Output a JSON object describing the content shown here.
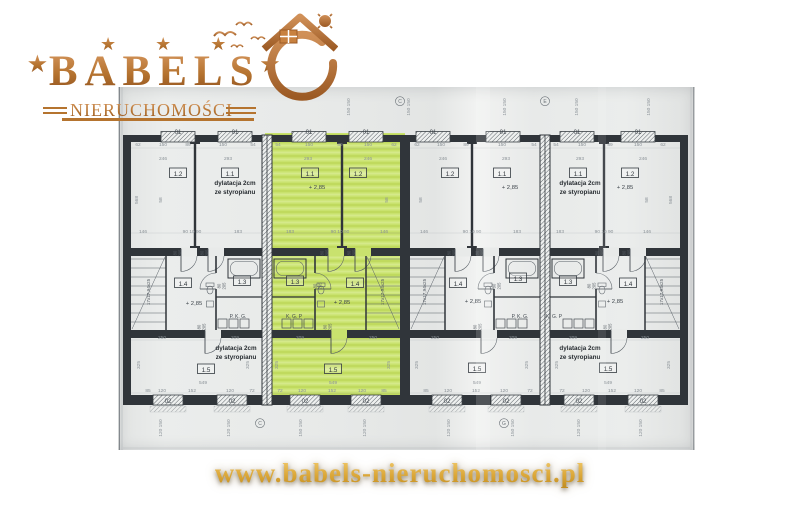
{
  "logo": {
    "stars": "★ ★ ★",
    "star": "★",
    "brand": "BABELS",
    "subtitle": "NIERUCHOMOŚCI"
  },
  "footer": {
    "url": "www.babels-nieruchomosci.pl"
  },
  "colors": {
    "copper": "#b5732f",
    "gold": "#dca839",
    "highlight_green": "#c9e26e",
    "paper": "#e8eae9",
    "wall": "#30353a",
    "thin_line": "#596067",
    "dim_text": "#8a9197"
  },
  "plan": {
    "width": 577,
    "height": 363,
    "green_rect": {
      "x": 147,
      "y": 46,
      "w": 140,
      "h": 272
    },
    "bands": {
      "top": [
        48,
        55
      ],
      "mid": [
        161,
        169
      ],
      "low": [
        243,
        251
      ],
      "bottom": [
        308,
        318
      ]
    },
    "ext_walls": [
      [
        5,
        13
      ],
      [
        562,
        570
      ]
    ],
    "joint_walls": [
      [
        144,
        154
      ],
      [
        422,
        432
      ]
    ],
    "party_wall": [
      282,
      292
    ],
    "units": [
      {
        "x0": 13,
        "x1": 144,
        "mir": false,
        "green": false,
        "part": 77,
        "winTop": [
          60,
          117
        ],
        "winBot": [
          50,
          114
        ],
        "doorMid": [
          60,
          87
        ],
        "doorLow": 84,
        "stairs": [
          13,
          48
        ],
        "tub": [
          110,
          142
        ],
        "bathx": 98
      },
      {
        "x0": 154,
        "x1": 282,
        "mir": true,
        "green": true,
        "part": 224,
        "winTop": [
          191,
          248
        ],
        "winBot": [
          187,
          248
        ],
        "doorMid": [
          207,
          234
        ],
        "doorLow": 210,
        "stairs": [
          248,
          282
        ],
        "tub": [
          156,
          188
        ],
        "bathx": 197
      },
      {
        "x0": 292,
        "x1": 422,
        "mir": false,
        "green": false,
        "part": 354,
        "winTop": [
          315,
          385
        ],
        "winBot": [
          329,
          388
        ],
        "doorMid": [
          334,
          362
        ],
        "doorLow": 360,
        "stairs": [
          292,
          327
        ],
        "tub": [
          388,
          420
        ],
        "bathx": 376
      },
      {
        "x0": 432,
        "x1": 562,
        "mir": true,
        "green": false,
        "part": 486,
        "winTop": [
          459,
          520
        ],
        "winBot": [
          461,
          525
        ],
        "doorMid": [
          482,
          509
        ],
        "doorLow": 490,
        "stairs": [
          527,
          562
        ],
        "tub": [
          434,
          466
        ],
        "bathx": 478
      }
    ],
    "door_label": [
      "80",
      "205"
    ],
    "door_positions": [
      [
        60,
        166
      ],
      [
        87,
        166
      ],
      [
        207,
        166
      ],
      [
        234,
        166
      ],
      [
        334,
        166
      ],
      [
        362,
        166
      ],
      [
        482,
        166
      ],
      [
        509,
        166
      ],
      [
        84,
        240
      ],
      [
        210,
        240
      ],
      [
        360,
        240
      ],
      [
        490,
        240
      ],
      [
        104,
        199
      ],
      [
        200,
        199
      ],
      [
        379,
        199
      ],
      [
        474,
        199
      ]
    ],
    "labels": [
      [
        60,
        89,
        "1.2",
        "r"
      ],
      [
        112,
        89,
        "1.1",
        "r"
      ],
      [
        65,
        199,
        "1.4",
        "r"
      ],
      [
        124,
        197,
        "1.3",
        "r"
      ],
      [
        88,
        285,
        "1.5",
        "r"
      ],
      [
        192,
        89,
        "1.1",
        "r"
      ],
      [
        240,
        89,
        "1.2",
        "r"
      ],
      [
        177,
        197,
        "1.3",
        "r"
      ],
      [
        237,
        199,
        "1.4",
        "r"
      ],
      [
        215,
        285,
        "1.5",
        "r"
      ],
      [
        332,
        89,
        "1.2",
        "r"
      ],
      [
        384,
        89,
        "1.1",
        "r"
      ],
      [
        400,
        194,
        "1.3",
        "r"
      ],
      [
        340,
        199,
        "1.4",
        "r"
      ],
      [
        359,
        284,
        "1.5",
        "r"
      ],
      [
        460,
        89,
        "1.1",
        "r"
      ],
      [
        512,
        89,
        "1.2",
        "r"
      ],
      [
        450,
        197,
        "1.3",
        "r"
      ],
      [
        510,
        199,
        "1.4",
        "r"
      ],
      [
        490,
        284,
        "1.5",
        "r"
      ],
      [
        199,
        102,
        "+ 2,85",
        "l"
      ],
      [
        392,
        102,
        "+ 2,85",
        "l"
      ],
      [
        507,
        102,
        "+ 2,85",
        "l"
      ],
      [
        76,
        218,
        "+ 2,85",
        "l"
      ],
      [
        224,
        217,
        "+ 2,85",
        "l"
      ],
      [
        355,
        216,
        "+ 2,85",
        "l"
      ],
      [
        497,
        216,
        "+ 2,85",
        "l"
      ],
      [
        117,
        98,
        "dylatacja 2cm",
        "n"
      ],
      [
        117,
        107,
        "ze styropianu",
        "n"
      ],
      [
        462,
        98,
        "dylatacja 2cm",
        "n"
      ],
      [
        462,
        107,
        "ze styropianu",
        "n"
      ],
      [
        118,
        263,
        "dylatacja 2cm",
        "n"
      ],
      [
        118,
        272,
        "ze styropianu",
        "n"
      ],
      [
        462,
        263,
        "dylatacja 2cm",
        "n"
      ],
      [
        462,
        272,
        "ze styropianu",
        "n"
      ],
      [
        60,
        47,
        "01",
        "m"
      ],
      [
        117,
        47,
        "01",
        "m"
      ],
      [
        191,
        47,
        "01",
        "m"
      ],
      [
        248,
        47,
        "01",
        "m"
      ],
      [
        315,
        47,
        "01",
        "m"
      ],
      [
        385,
        47,
        "01",
        "m"
      ],
      [
        459,
        47,
        "01",
        "m"
      ],
      [
        520,
        47,
        "01",
        "m"
      ],
      [
        50,
        316,
        "02",
        "m"
      ],
      [
        114,
        316,
        "02",
        "m"
      ],
      [
        187,
        316,
        "02",
        "m"
      ],
      [
        248,
        316,
        "02",
        "m"
      ],
      [
        329,
        316,
        "02",
        "m"
      ],
      [
        388,
        316,
        "02",
        "m"
      ],
      [
        461,
        316,
        "02",
        "m"
      ],
      [
        525,
        316,
        "02",
        "m"
      ],
      [
        32,
        205,
        "17x17,94x25",
        "s"
      ],
      [
        266,
        205,
        "17x17,94x25",
        "s"
      ],
      [
        308,
        205,
        "17x17,94x25",
        "s"
      ],
      [
        545,
        205,
        "17x17,94x25",
        "s"
      ],
      [
        120,
        231,
        "P. K. G.",
        "p"
      ],
      [
        176,
        231,
        "K. G. P",
        "p"
      ],
      [
        402,
        231,
        "P. K. G.",
        "p"
      ],
      [
        436,
        231,
        "K. G. P",
        "p"
      ],
      [
        20,
        59,
        "62",
        "d"
      ],
      [
        45,
        59,
        "150",
        "d"
      ],
      [
        70,
        59,
        "89",
        "d"
      ],
      [
        105,
        59,
        "150",
        "d"
      ],
      [
        135,
        59,
        "54",
        "d"
      ],
      [
        160,
        59,
        "54",
        "d"
      ],
      [
        191,
        59,
        "150",
        "d"
      ],
      [
        222,
        59,
        "89",
        "d"
      ],
      [
        250,
        59,
        "150",
        "d"
      ],
      [
        276,
        59,
        "62",
        "d"
      ],
      [
        299,
        59,
        "62",
        "d"
      ],
      [
        323,
        59,
        "150",
        "d"
      ],
      [
        348,
        59,
        "89",
        "d"
      ],
      [
        384,
        59,
        "150",
        "d"
      ],
      [
        416,
        59,
        "54",
        "d"
      ],
      [
        438,
        59,
        "54",
        "d"
      ],
      [
        464,
        59,
        "150",
        "d"
      ],
      [
        492,
        59,
        "89",
        "d"
      ],
      [
        520,
        59,
        "150",
        "d"
      ],
      [
        545,
        59,
        "62",
        "d"
      ],
      [
        45,
        73,
        "246",
        "d"
      ],
      [
        110,
        73,
        "293",
        "d"
      ],
      [
        190,
        73,
        "293",
        "d"
      ],
      [
        250,
        73,
        "246",
        "d"
      ],
      [
        325,
        73,
        "246",
        "d"
      ],
      [
        388,
        73,
        "293",
        "d"
      ],
      [
        462,
        73,
        "293",
        "d"
      ],
      [
        525,
        73,
        "246",
        "d"
      ],
      [
        25,
        146,
        "146",
        "d"
      ],
      [
        74,
        146,
        "90 10 90",
        "d"
      ],
      [
        120,
        146,
        "183",
        "d"
      ],
      [
        172,
        146,
        "183",
        "d"
      ],
      [
        222,
        146,
        "90 10 90",
        "d"
      ],
      [
        266,
        146,
        "146",
        "d"
      ],
      [
        306,
        146,
        "146",
        "d"
      ],
      [
        354,
        146,
        "90 10 90",
        "d"
      ],
      [
        399,
        146,
        "183",
        "d"
      ],
      [
        442,
        146,
        "183",
        "d"
      ],
      [
        486,
        146,
        "90 10 90",
        "d"
      ],
      [
        529,
        146,
        "146",
        "d"
      ],
      [
        44,
        252,
        "250",
        "d"
      ],
      [
        117,
        252,
        "209",
        "d"
      ],
      [
        182,
        252,
        "209",
        "d"
      ],
      [
        255,
        252,
        "250",
        "d"
      ],
      [
        317,
        252,
        "250",
        "d"
      ],
      [
        395,
        252,
        "209",
        "d"
      ],
      [
        455,
        252,
        "209",
        "d"
      ],
      [
        527,
        252,
        "250",
        "d"
      ],
      [
        85,
        297,
        "549",
        "d"
      ],
      [
        215,
        297,
        "549",
        "d"
      ],
      [
        359,
        297,
        "549",
        "d"
      ],
      [
        490,
        297,
        "549",
        "d"
      ],
      [
        30,
        305,
        "85",
        "d"
      ],
      [
        44,
        305,
        "120",
        "d"
      ],
      [
        74,
        305,
        "152",
        "d"
      ],
      [
        112,
        305,
        "120",
        "d"
      ],
      [
        134,
        305,
        "72",
        "d"
      ],
      [
        162,
        305,
        "72",
        "d"
      ],
      [
        184,
        305,
        "120",
        "d"
      ],
      [
        214,
        305,
        "152",
        "d"
      ],
      [
        244,
        305,
        "120",
        "d"
      ],
      [
        266,
        305,
        "85",
        "d"
      ],
      [
        308,
        305,
        "85",
        "d"
      ],
      [
        330,
        305,
        "120",
        "d"
      ],
      [
        358,
        305,
        "152",
        "d"
      ],
      [
        386,
        305,
        "120",
        "d"
      ],
      [
        412,
        305,
        "72",
        "d"
      ],
      [
        444,
        305,
        "72",
        "d"
      ],
      [
        468,
        305,
        "120",
        "d"
      ],
      [
        494,
        305,
        "152",
        "d"
      ],
      [
        520,
        305,
        "120",
        "d"
      ],
      [
        544,
        305,
        "85",
        "d"
      ],
      [
        232,
        20,
        "150 150",
        "v"
      ],
      [
        292,
        20,
        "150 150",
        "v"
      ],
      [
        388,
        20,
        "150 150",
        "v"
      ],
      [
        460,
        20,
        "150 150",
        "v"
      ],
      [
        532,
        20,
        "150 150",
        "v"
      ],
      [
        44,
        341,
        "120 150",
        "v"
      ],
      [
        112,
        341,
        "120 150",
        "v"
      ],
      [
        184,
        341,
        "150 150",
        "v"
      ],
      [
        248,
        341,
        "120 150",
        "v"
      ],
      [
        332,
        341,
        "120 150",
        "v"
      ],
      [
        396,
        341,
        "150 150",
        "v"
      ],
      [
        462,
        341,
        "120 150",
        "v"
      ],
      [
        524,
        341,
        "120 150",
        "v"
      ],
      [
        20,
        113,
        "568",
        "v"
      ],
      [
        44,
        113,
        "58",
        "v"
      ],
      [
        270,
        113,
        "58",
        "v"
      ],
      [
        304,
        113,
        "58",
        "v"
      ],
      [
        530,
        113,
        "58",
        "v"
      ],
      [
        554,
        113,
        "568",
        "v"
      ],
      [
        22,
        278,
        "325",
        "v"
      ],
      [
        131,
        278,
        "325",
        "v"
      ],
      [
        160,
        278,
        "325",
        "v"
      ],
      [
        272,
        278,
        "325",
        "v"
      ],
      [
        300,
        278,
        "325",
        "v"
      ],
      [
        410,
        278,
        "325",
        "v"
      ],
      [
        440,
        278,
        "325",
        "v"
      ],
      [
        552,
        278,
        "325",
        "v"
      ],
      [
        282,
        16,
        "C",
        "a"
      ],
      [
        427,
        16,
        "E",
        "a"
      ],
      [
        142,
        338,
        "C",
        "a"
      ],
      [
        386,
        338,
        "G",
        "a"
      ]
    ]
  }
}
